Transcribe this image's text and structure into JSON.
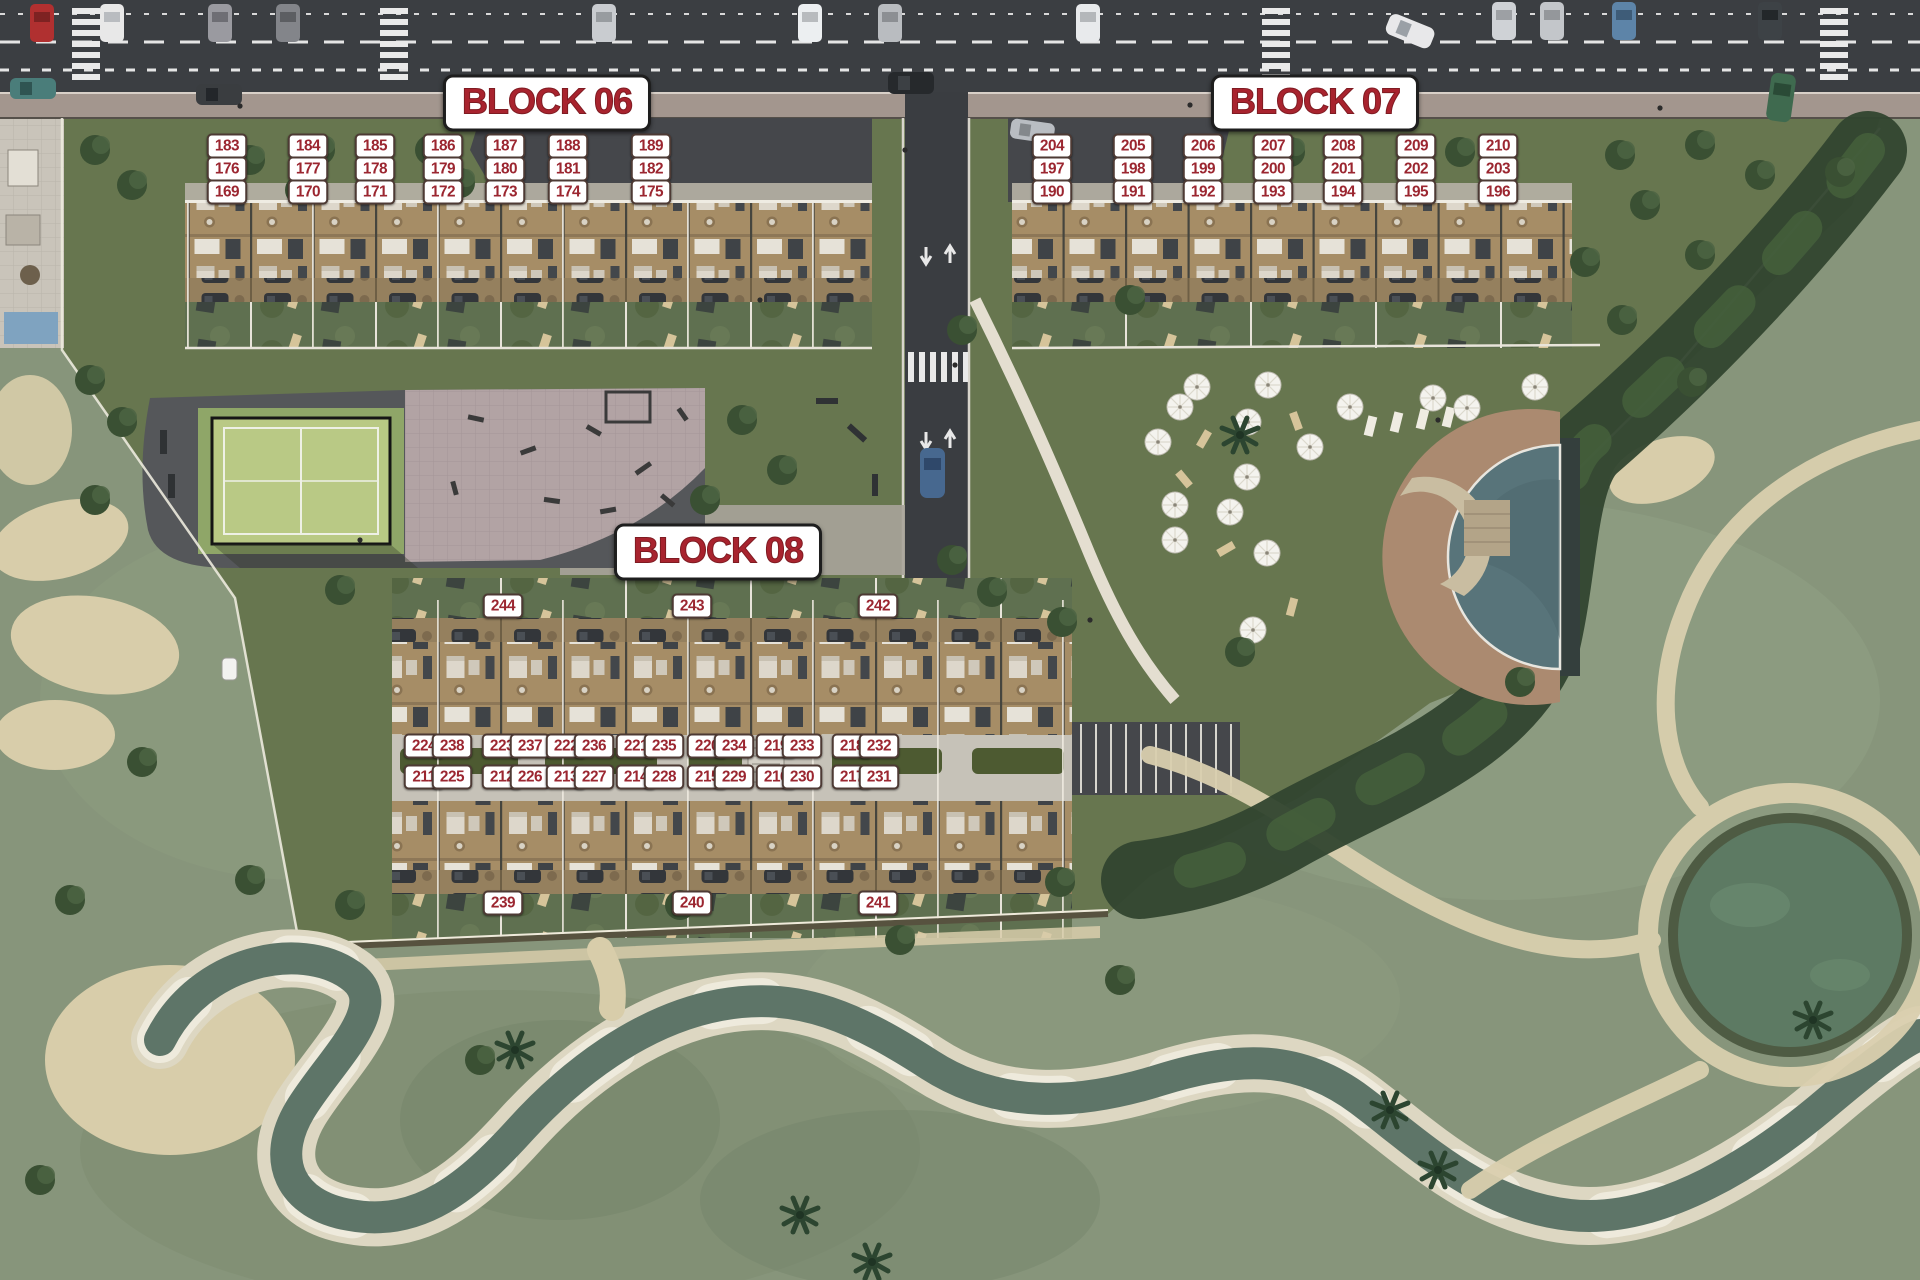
{
  "plan": {
    "kind": "residential-development-site-plan-aerial",
    "colors": {
      "label_text": "#9b2630",
      "label_bg": "#ffffff",
      "label_border": "#4d3a34",
      "title_text": "#a8232e",
      "road": "#3b3e42",
      "sidewalk": "#a3968e",
      "site_green": "#67764f",
      "golf_green": "#87957b",
      "building_tan": "#a68d66",
      "pool_water": "#587478",
      "sand": "#d8cdaa",
      "padel_court": "#b9c985",
      "plaza_pink": "#b2a3a4"
    }
  },
  "blocks": [
    {
      "id": "block-06",
      "title": "BLOCK 06",
      "title_x": 547,
      "title_y": 103,
      "units": [
        {
          "n": "183",
          "x": 227,
          "y": 146
        },
        {
          "n": "184",
          "x": 308,
          "y": 146
        },
        {
          "n": "185",
          "x": 375,
          "y": 146
        },
        {
          "n": "186",
          "x": 443,
          "y": 146
        },
        {
          "n": "187",
          "x": 505,
          "y": 146
        },
        {
          "n": "188",
          "x": 568,
          "y": 146
        },
        {
          "n": "189",
          "x": 651,
          "y": 146
        },
        {
          "n": "176",
          "x": 227,
          "y": 169
        },
        {
          "n": "177",
          "x": 308,
          "y": 169
        },
        {
          "n": "178",
          "x": 375,
          "y": 169
        },
        {
          "n": "179",
          "x": 443,
          "y": 169
        },
        {
          "n": "180",
          "x": 505,
          "y": 169
        },
        {
          "n": "181",
          "x": 568,
          "y": 169
        },
        {
          "n": "182",
          "x": 651,
          "y": 169
        },
        {
          "n": "169",
          "x": 227,
          "y": 192
        },
        {
          "n": "170",
          "x": 308,
          "y": 192
        },
        {
          "n": "171",
          "x": 375,
          "y": 192
        },
        {
          "n": "172",
          "x": 443,
          "y": 192
        },
        {
          "n": "173",
          "x": 505,
          "y": 192
        },
        {
          "n": "174",
          "x": 568,
          "y": 192
        },
        {
          "n": "175",
          "x": 651,
          "y": 192
        }
      ]
    },
    {
      "id": "block-07",
      "title": "BLOCK 07",
      "title_x": 1315,
      "title_y": 103,
      "units": [
        {
          "n": "204",
          "x": 1052,
          "y": 146
        },
        {
          "n": "205",
          "x": 1133,
          "y": 146
        },
        {
          "n": "206",
          "x": 1203,
          "y": 146
        },
        {
          "n": "207",
          "x": 1273,
          "y": 146
        },
        {
          "n": "208",
          "x": 1343,
          "y": 146
        },
        {
          "n": "209",
          "x": 1416,
          "y": 146
        },
        {
          "n": "210",
          "x": 1498,
          "y": 146
        },
        {
          "n": "197",
          "x": 1052,
          "y": 169
        },
        {
          "n": "198",
          "x": 1133,
          "y": 169
        },
        {
          "n": "199",
          "x": 1203,
          "y": 169
        },
        {
          "n": "200",
          "x": 1273,
          "y": 169
        },
        {
          "n": "201",
          "x": 1343,
          "y": 169
        },
        {
          "n": "202",
          "x": 1416,
          "y": 169
        },
        {
          "n": "203",
          "x": 1498,
          "y": 169
        },
        {
          "n": "190",
          "x": 1052,
          "y": 192
        },
        {
          "n": "191",
          "x": 1133,
          "y": 192
        },
        {
          "n": "192",
          "x": 1203,
          "y": 192
        },
        {
          "n": "193",
          "x": 1273,
          "y": 192
        },
        {
          "n": "194",
          "x": 1343,
          "y": 192
        },
        {
          "n": "195",
          "x": 1416,
          "y": 192
        },
        {
          "n": "196",
          "x": 1498,
          "y": 192
        }
      ]
    },
    {
      "id": "block-08",
      "title": "BLOCK 08",
      "title_x": 718,
      "title_y": 552,
      "units": [
        {
          "n": "244",
          "x": 503,
          "y": 606
        },
        {
          "n": "243",
          "x": 692,
          "y": 606
        },
        {
          "n": "242",
          "x": 878,
          "y": 606
        },
        {
          "n": "224",
          "x": 424,
          "y": 746
        },
        {
          "n": "238",
          "x": 452,
          "y": 746
        },
        {
          "n": "223",
          "x": 502,
          "y": 746
        },
        {
          "n": "237",
          "x": 530,
          "y": 746
        },
        {
          "n": "222",
          "x": 566,
          "y": 746
        },
        {
          "n": "236",
          "x": 594,
          "y": 746
        },
        {
          "n": "221",
          "x": 636,
          "y": 746
        },
        {
          "n": "235",
          "x": 664,
          "y": 746
        },
        {
          "n": "220",
          "x": 707,
          "y": 746
        },
        {
          "n": "234",
          "x": 734,
          "y": 746
        },
        {
          "n": "219",
          "x": 776,
          "y": 746
        },
        {
          "n": "233",
          "x": 802,
          "y": 746
        },
        {
          "n": "218",
          "x": 852,
          "y": 746
        },
        {
          "n": "232",
          "x": 879,
          "y": 746
        },
        {
          "n": "211",
          "x": 424,
          "y": 777
        },
        {
          "n": "225",
          "x": 452,
          "y": 777
        },
        {
          "n": "212",
          "x": 502,
          "y": 777
        },
        {
          "n": "226",
          "x": 530,
          "y": 777
        },
        {
          "n": "213",
          "x": 566,
          "y": 777
        },
        {
          "n": "227",
          "x": 594,
          "y": 777
        },
        {
          "n": "214",
          "x": 636,
          "y": 777
        },
        {
          "n": "228",
          "x": 664,
          "y": 777
        },
        {
          "n": "215",
          "x": 707,
          "y": 777
        },
        {
          "n": "229",
          "x": 734,
          "y": 777
        },
        {
          "n": "216",
          "x": 776,
          "y": 777
        },
        {
          "n": "230",
          "x": 802,
          "y": 777
        },
        {
          "n": "217",
          "x": 852,
          "y": 777
        },
        {
          "n": "231",
          "x": 879,
          "y": 777
        },
        {
          "n": "239",
          "x": 503,
          "y": 903
        },
        {
          "n": "240",
          "x": 692,
          "y": 903
        },
        {
          "n": "241",
          "x": 878,
          "y": 903
        }
      ]
    }
  ]
}
